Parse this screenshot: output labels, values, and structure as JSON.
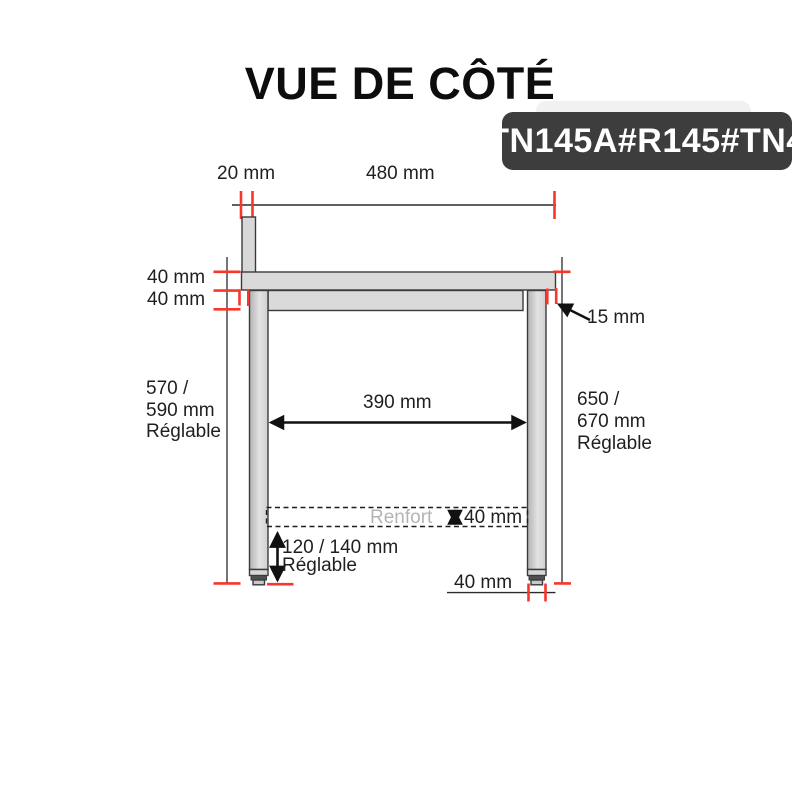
{
  "page": {
    "title": "VUE DE CÔTÉ",
    "badge": "TN145A#R145#TN4"
  },
  "dimensions": {
    "upstand_width": "20 mm",
    "top_width": "480 mm",
    "top_thickness": "40 mm",
    "rail_thickness": "40 mm",
    "overhang": "15 mm",
    "left_height": {
      "l1": "570 /",
      "l2": "590 mm",
      "l3": "Réglable"
    },
    "inner_width": "390 mm",
    "right_height": {
      "l1": "650 /",
      "l2": "670 mm",
      "l3": "Réglable"
    },
    "renfort_label": "Renfort",
    "renfort_thickness": "40 mm",
    "foot_height": {
      "l1": "120 / 140 mm",
      "l2": "Réglable"
    },
    "leg_width": "40 mm"
  },
  "colors": {
    "accent_red": "#f8372a",
    "badge_bg": "#3d3d3d",
    "badge_text": "#ffffff",
    "shape_fill": "#dadada",
    "shape_stroke": "#3a3a3a",
    "dim_line": "#2b2b2b",
    "text": "#1f1f1f",
    "muted_text": "#b4b4b4"
  }
}
